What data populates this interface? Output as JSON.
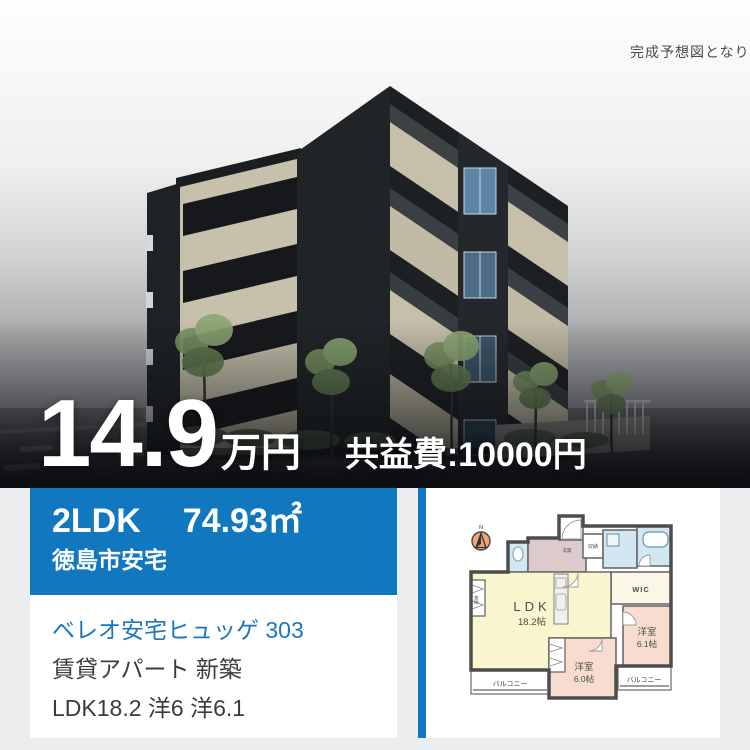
{
  "photo": {
    "caption": "完成予想図となり",
    "price_amount": "14.9",
    "price_unit": "万円",
    "common_fee": "共益費:10000円"
  },
  "summary": {
    "layout": "2LDK",
    "area": "74.93㎡",
    "location": "徳島市安宅"
  },
  "details": {
    "name": "ベレオ安宅ヒュッゲ 303",
    "category_line": "賃貸アパート 新築",
    "rooms_line": "LDK18.2 洋6 洋6.1"
  },
  "floorplan": {
    "compass": "N",
    "ldk_name": "LDK",
    "ldk_size": "18.2帖",
    "bedroom1_name": "洋室",
    "bedroom1_size": "6.1帖",
    "bedroom2_name": "洋室",
    "bedroom2_size": "6.0帖",
    "wic": "WIC",
    "balcony_left": "バルコニー",
    "balcony_right": "バルコニー",
    "closet_entrance": "収納",
    "closet_ldk": "収納",
    "entrance": "玄関"
  },
  "colors": {
    "accent_blue": "#1178c0",
    "link_blue": "#1b77bd",
    "section_bg": "#ecedef"
  }
}
